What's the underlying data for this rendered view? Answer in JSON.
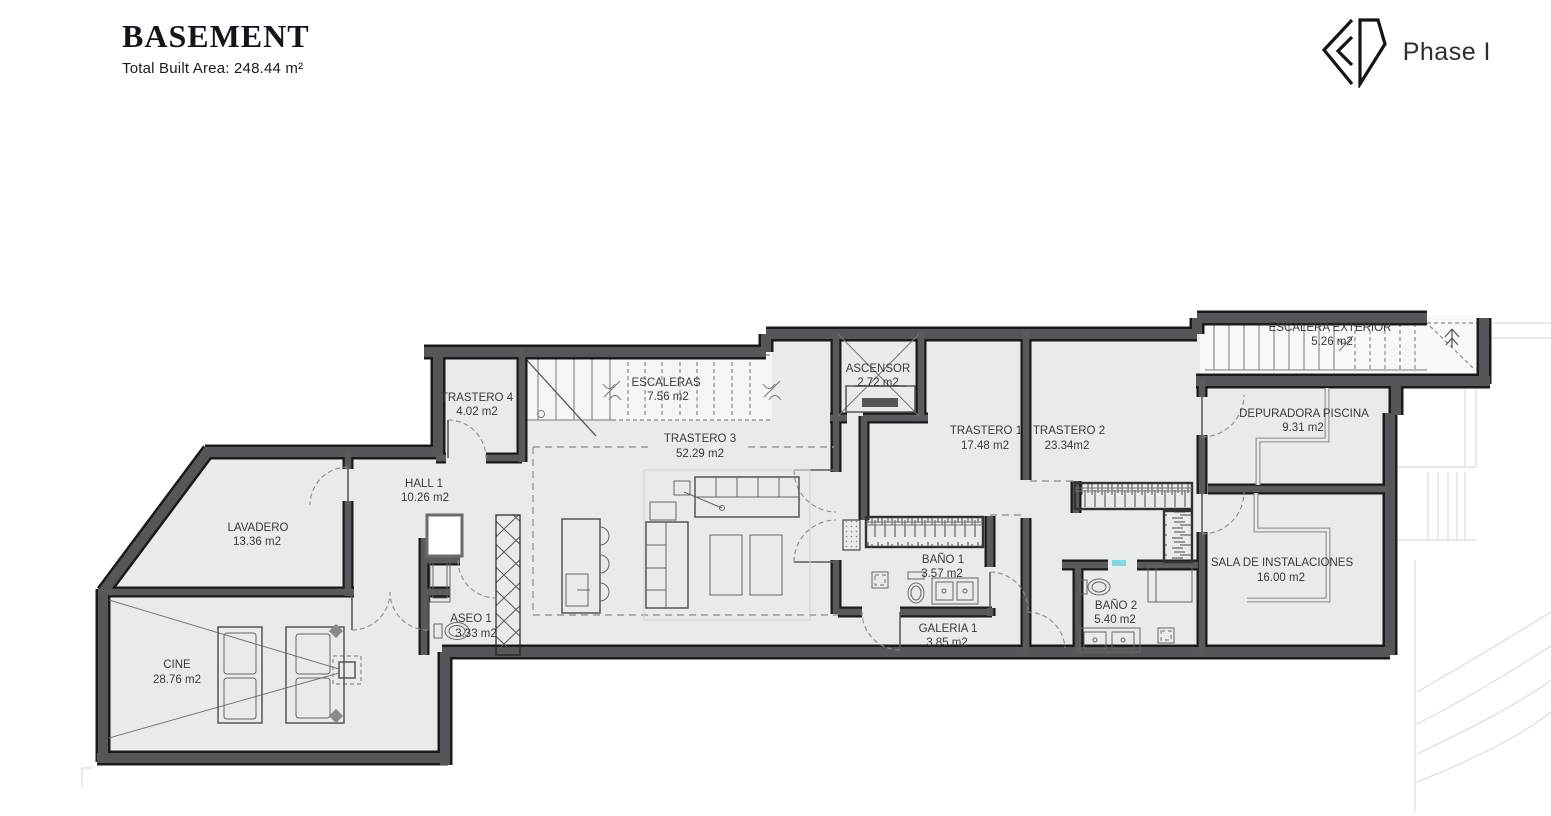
{
  "header": {
    "title": "BASEMENT",
    "subtitle": "Total Built Area: 248.44 m²"
  },
  "brand": {
    "phase": "Phase I",
    "logo": "sd-diamond-logo"
  },
  "colors": {
    "wall": "#55565a",
    "wall_edge": "#1b1b1b",
    "floor": "#e9eaea",
    "cushion": "#cdd4e6",
    "slider_accent": "#7fd8e8"
  },
  "rooms": [
    {
      "name": "TRASTERO 4",
      "area": "4.02 m2"
    },
    {
      "name": "ESCALERAS",
      "area": "7.56 m2"
    },
    {
      "name": "ASCENSOR",
      "area": "2.72 m2"
    },
    {
      "name": "TRASTERO 1",
      "area": "17.48 m2"
    },
    {
      "name": "TRASTERO 2",
      "area": "23.34m2"
    },
    {
      "name": "ESCALERA EXTERIOR",
      "area": "5.26 m2"
    },
    {
      "name": "DEPURADORA PISCINA",
      "area": "9.31 m2"
    },
    {
      "name": "TRASTERO 3",
      "area": "52.29 m2"
    },
    {
      "name": "HALL 1",
      "area": "10.26 m2"
    },
    {
      "name": "LAVADERO",
      "area": "13.36 m2"
    },
    {
      "name": "ASEO 1",
      "area": "3.33 m2"
    },
    {
      "name": "BAÑO 1",
      "area": "3.57 m2"
    },
    {
      "name": "BAÑO 2",
      "area": "5.40 m2"
    },
    {
      "name": "GALERIA 1",
      "area": "3.85 m2"
    },
    {
      "name": "SALA DE INSTALACIONES",
      "area": "16.00 m2"
    },
    {
      "name": "CINE",
      "area": "28.76 m2"
    }
  ]
}
